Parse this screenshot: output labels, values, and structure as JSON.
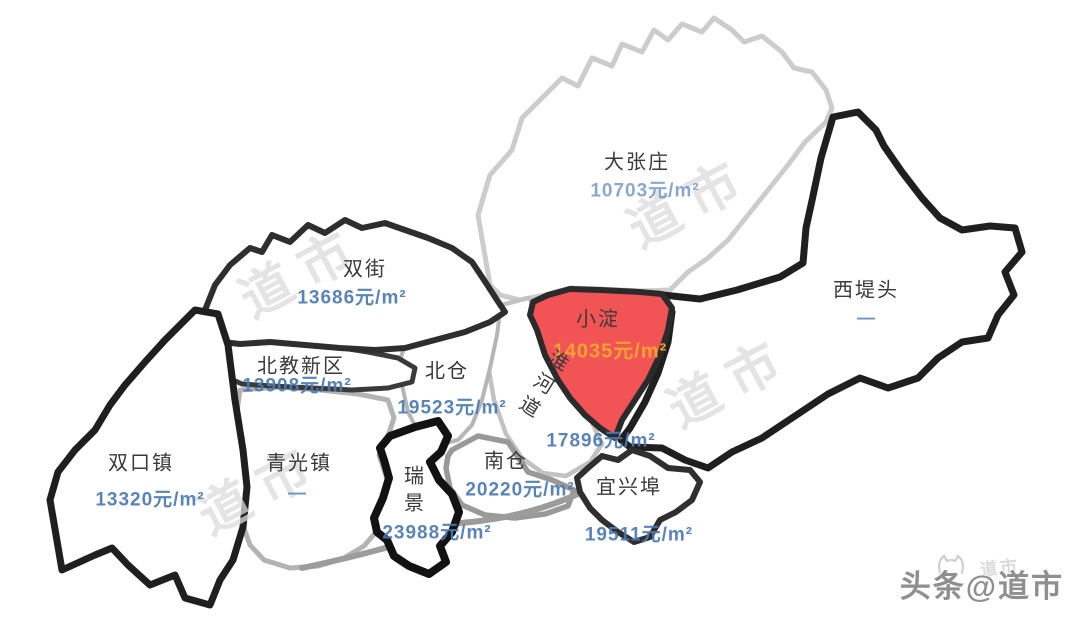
{
  "watermark": {
    "text": "道市"
  },
  "attribution": {
    "text": "头条@道市"
  },
  "colors": {
    "highlight_fill": "#f25456",
    "price_text": "#4a7ab5",
    "highlight_price_text": "#f0a22e",
    "region_name_text": "#3a3a3a",
    "watermark_text": "#dcdcdc",
    "attribution_text": "#8f8f8f"
  },
  "regions": [
    {
      "id": "dazhangzhuang",
      "name": "大张庄",
      "price": "10703元/m²"
    },
    {
      "id": "shuangjie",
      "name": "双街",
      "price": "13686元/m²"
    },
    {
      "id": "xiditou",
      "name": "西堤头",
      "price": "—"
    },
    {
      "id": "xiaodian",
      "name": "小淀",
      "price": "14035元/m²",
      "highlighted": true
    },
    {
      "id": "beijiaoxinqu",
      "name": "北教新区",
      "price": "13908元/m²"
    },
    {
      "id": "beicang",
      "name": "北仓",
      "price": "19523元/m²"
    },
    {
      "id": "huaihedao",
      "name": "淮河道",
      "price": "17896元/m²"
    },
    {
      "id": "shuangkouzhen",
      "name": "双口镇",
      "price": "13320元/m²"
    },
    {
      "id": "qingguangzhen",
      "name": "青光镇",
      "price": "—"
    },
    {
      "id": "ruijing",
      "name": "瑞景",
      "price": "23988元/m²"
    },
    {
      "id": "nancang",
      "name": "南仓",
      "price": "20220元/m²"
    },
    {
      "id": "yixingbu",
      "name": "宜兴埠",
      "price": "19511元/m²"
    }
  ]
}
